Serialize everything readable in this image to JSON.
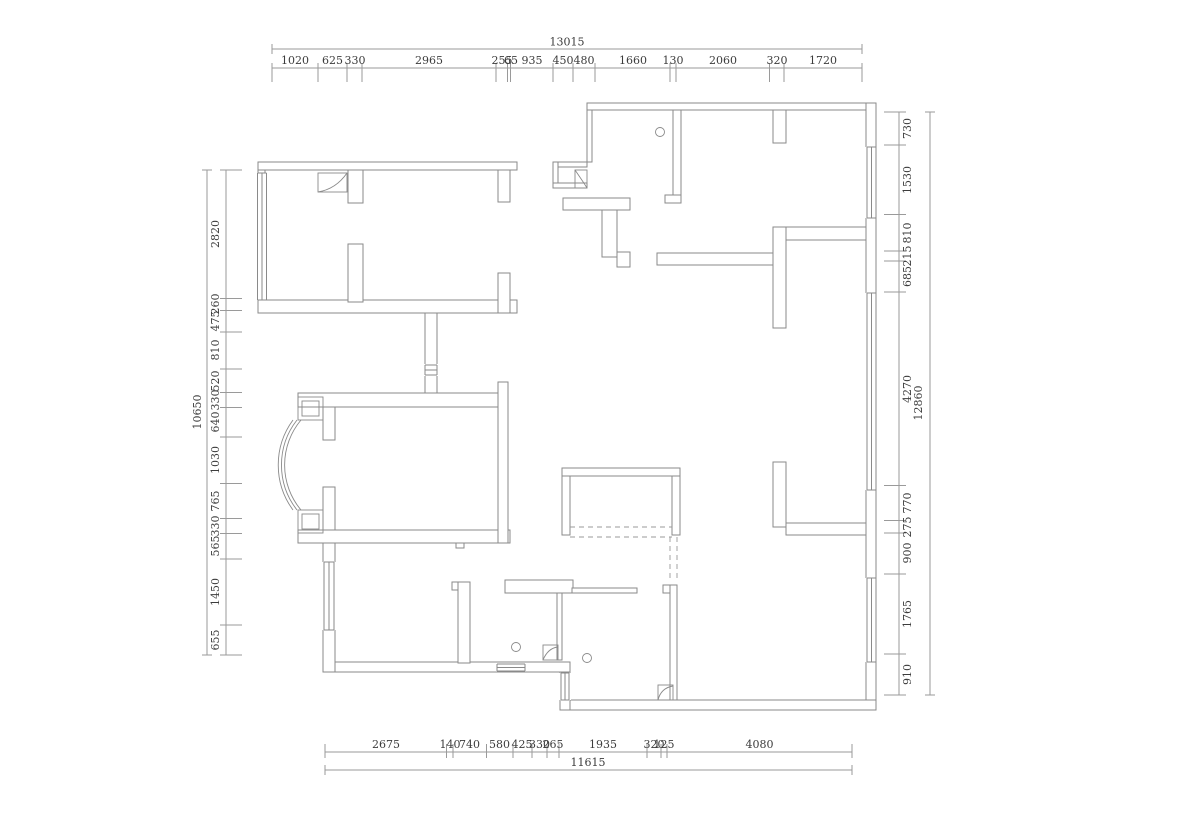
{
  "drawing_title": "apartment floor plan",
  "colors": {
    "wall_line": "#8a8a8a",
    "dimension_line": "#9a9a9a",
    "text": "#3c3c3c",
    "background": "#ffffff"
  },
  "dims": {
    "top": {
      "total": "13015",
      "segments": [
        "1020",
        "625",
        "330",
        "2965",
        "255",
        "65",
        "935",
        "450",
        "480",
        "1660",
        "130",
        "2060",
        "320",
        "1720"
      ]
    },
    "left": {
      "total": "10650",
      "segments": [
        "2820",
        "260",
        "475",
        "810",
        "520",
        "330",
        "640",
        "1030",
        "765",
        "330",
        "565",
        "1450",
        "655"
      ]
    },
    "right": {
      "total": "12860",
      "segments": [
        "730",
        "1530",
        "810",
        "215",
        "685",
        "4270",
        "770",
        "275",
        "900",
        "1765",
        "910"
      ]
    },
    "bottom": {
      "total": "11615",
      "segments": [
        "2675",
        "140",
        "740",
        "580",
        "425",
        "330",
        "265",
        "1935",
        "320",
        "125",
        "4080"
      ]
    }
  },
  "symbols": {
    "door_leaf_count": "4",
    "floor_drain_count": "3"
  }
}
